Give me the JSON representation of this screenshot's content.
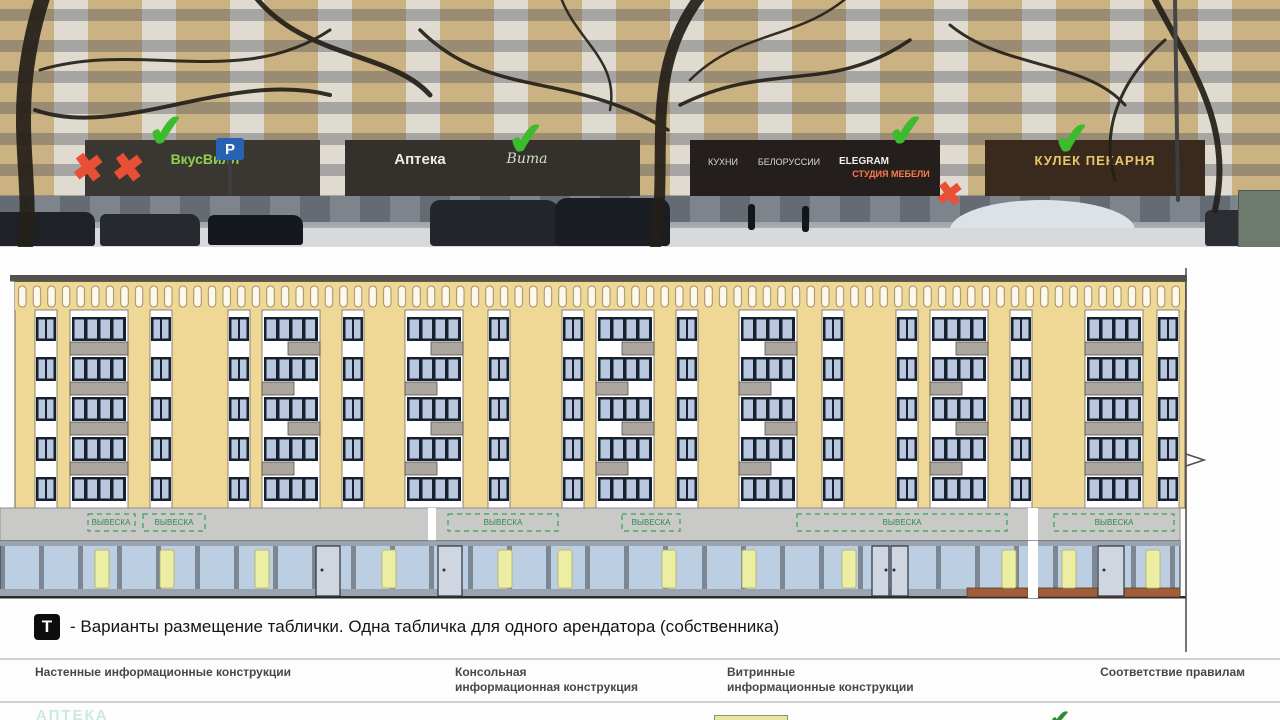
{
  "photo": {
    "marks": {
      "check": "✔",
      "cross": "✖"
    },
    "signs": {
      "vkusvill": "ВкусВилл",
      "parking": "Р",
      "apteka": "Аптека",
      "apteka_script": "Вита",
      "mid1": "КУХНИ",
      "mid2": "БЕЛОРУССИИ",
      "mid3": "ELEGRAM",
      "mid4": "СТУДИЯ МЕБЕЛИ",
      "bakery": "КУЛЕК ПЕКАРНЯ"
    }
  },
  "drawing": {
    "sign_zone_label": "ВЫВЕСКА"
  },
  "legend": {
    "icon_label": "Т",
    "text": "- Варианты размещение таблички. Одна табличка для одного арендатора (собственника)"
  },
  "footer": {
    "columns": [
      {
        "line1": "Настенные информационные конструкции",
        "line2": ""
      },
      {
        "line1": "Консольная",
        "line2": "информационная конструкция"
      },
      {
        "line1": "Витринные",
        "line2": "информационные конструкции"
      },
      {
        "line1": "Соответствие правилам",
        "line2": ""
      }
    ]
  },
  "bottom": {
    "partial_text": "АПТЕКА",
    "partial_check": "✔"
  },
  "colors": {
    "facade_yellow": "#efd795",
    "balcony_gray": "#aba69e",
    "glass_blue": "#b9c8df",
    "fascia_gray": "#c9c9c7",
    "zone_green": "#2e8a4e",
    "check_green": "#3dbb2e",
    "cross_red": "#e94f35",
    "highlight_yellow": "#ecefa3"
  }
}
